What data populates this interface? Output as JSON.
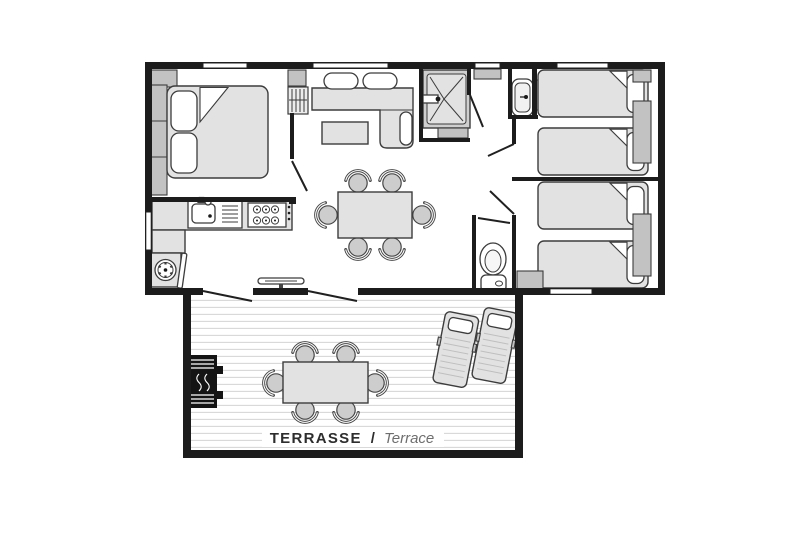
{
  "floorplan": {
    "type": "mobile-home-floor-plan",
    "terrace_label": {
      "fr": "TERRASSE",
      "separator": "/",
      "en": "Terrace"
    },
    "colors": {
      "wall": "#1c1c1c",
      "line": "#3c3c3c",
      "furnLight": "#e2e2e2",
      "furnMid": "#c2c2c2",
      "deck": "#d9d9d9",
      "bbq": "#141414",
      "textDark": "#2d2d2d",
      "textMuted": "#6e6e6e"
    },
    "icons": [
      "double-bed-icon",
      "single-bed-icon",
      "wardrobe-icon",
      "hanging-wardrobe-icon",
      "sofa-icon",
      "coffee-table-icon",
      "dining-table-icon",
      "chair-icon",
      "kitchen-sink-icon",
      "stove-icon",
      "washing-machine-icon",
      "shower-icon",
      "washbasin-icon",
      "toilet-icon",
      "bbq-icon",
      "sun-lounger-icon",
      "folding-table-icon",
      "window-icon",
      "door-swing-icon"
    ]
  }
}
